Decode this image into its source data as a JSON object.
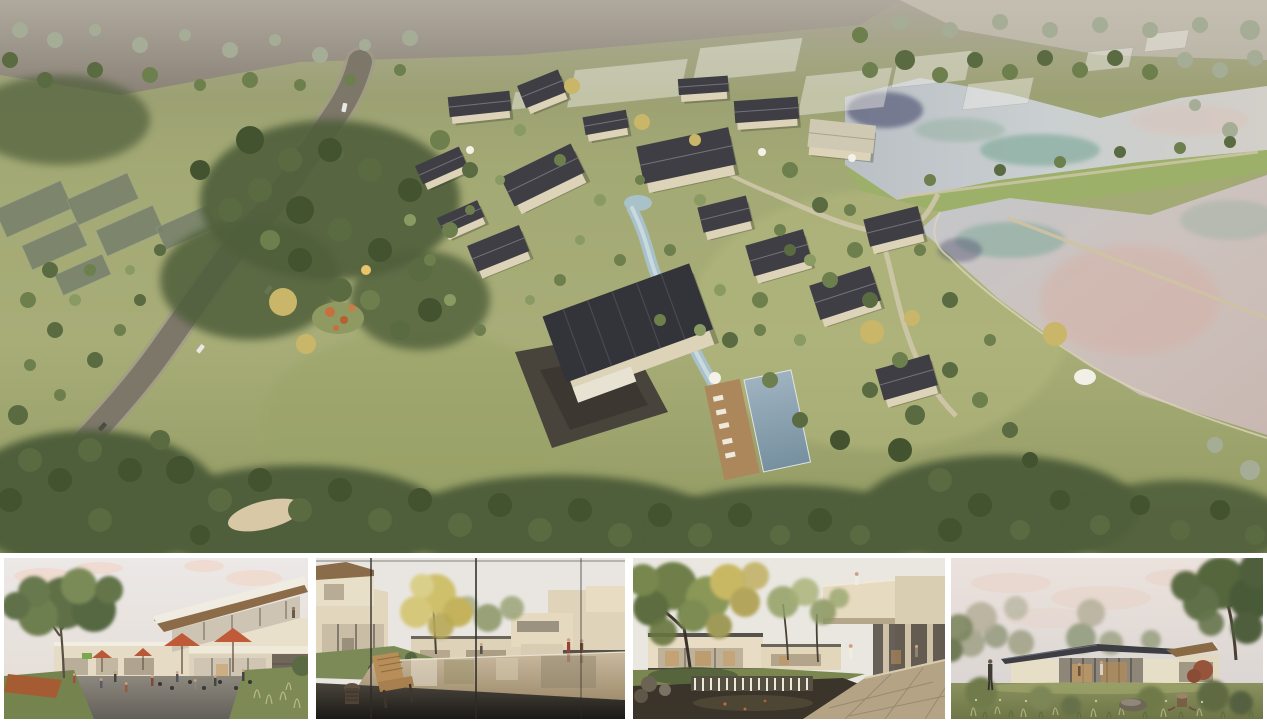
{
  "board": {
    "type": "architectural rendering presentation board",
    "background": "#ffffff",
    "text_content": "none — image-only board with no visible text, labels or captions"
  },
  "hero": {
    "label": "aerial-masterplan-rendering",
    "description": "Bird's-eye rendering of a courtyard village resort: beige houses with dark pitched roofs clustered around a winding pale-blue stream, a dark stone plaza, a timber deck with loungers and a rectangular pool; meadows and dense woodland around the site; a curving grey access road with cars on the left; tilted grey glasshouse plots at the left edge; translucent white future-phase massing blocks on the upper slope; two large silvery ponds with teal, navy and peach reflections on the right, separated by a grassy berm with a footpath and crossed by a thin weir causeway; hazy pale fields and trees along the top edge; a small white shade canopy by the lower pond shore."
  },
  "thumbnails": [
    {
      "label": "street-plaza-view",
      "description": "Eye-level view of a two-storey clubhouse with a slanted timber roof and glass upper floor; cafe terrace with orange parasols, tables and visitors; low shop fronts with small green and yellow signs; a large tree on the left and pale pink evening sky."
    },
    {
      "label": "courtyard-pond-view",
      "description": "View through a glazed wall (dark vertical mullions) toward a reflecting pond courtyard ringed by beige flat-roofed buildings; golden-leaved tree, grass slope with rocks, a wooden slatted lounge chair and carved stool on a dark floor; two walkers in red and brown on the far right."
    },
    {
      "label": "garden-waterfall-view",
      "description": "Shaded garden court with a large mixed green-and-gold tree; cream buildings with warm lit glazing; a cantilevered wing with a person on its roof terrace and a colonnade below; dark pond spilling over a stone weir with white falling water; wide stone paving in the foreground; a strolling figure in white."
    },
    {
      "label": "lawn-pavilion-view",
      "description": "Single-storey pavilion with a thin dark hip roof, cream walls and a warm-lit glass centre with figures inside, set on an open lawn; tall dark tree on the right with a red-leaf shrub; hazy distant trees; ornamental grasses, a boulder, a tree stump and a dark-dressed visitor under a pastel cloudy sky."
    }
  ],
  "palette": {
    "canvas": "#ffffff",
    "meadow": "#a4aa74",
    "forest": "#4d5c3a",
    "roof_dark": "#3b3b41",
    "wall_beige": "#d9cfb4",
    "road_grey": "#7d7769",
    "water_silver": "#c6cacd",
    "water_teal": "#79a795",
    "water_peach": "#d4b3a8",
    "water_navy": "#3c4166",
    "stream_blue": "#a9c2ca",
    "pool_blue": "#8299ac",
    "deck_wood": "#ad875c",
    "parasol_orange": "#c05a38",
    "gold_foliage": "#c9b668",
    "sky_pink": "#e9e0dc",
    "stone_plaza": "#48443c"
  }
}
